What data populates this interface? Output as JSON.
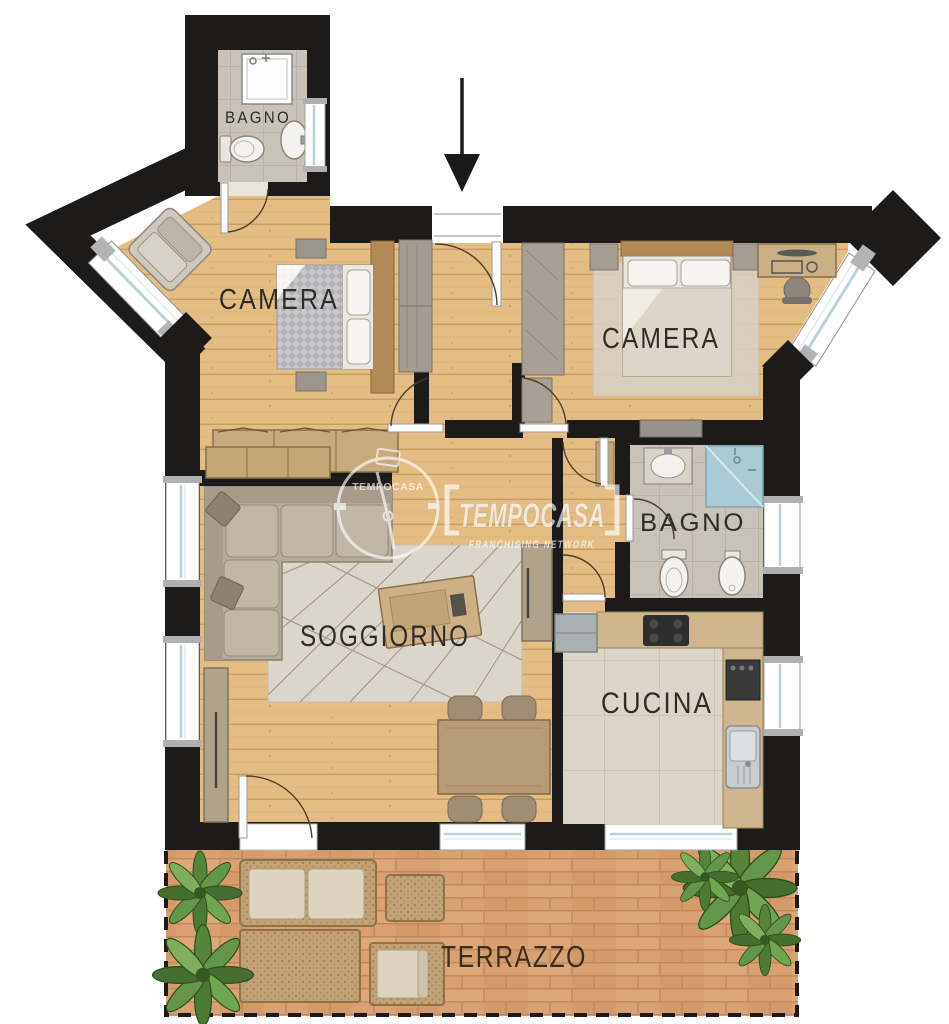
{
  "plan": {
    "type": "apartment-floorplan",
    "rooms": {
      "bagno_top": {
        "label": "BAGNO"
      },
      "camera_left": {
        "label": "CAMERA"
      },
      "camera_right": {
        "label": "CAMERA"
      },
      "bagno_right": {
        "label": "BAGNO"
      },
      "soggiorno": {
        "label": "SOGGIORNO"
      },
      "cucina": {
        "label": "CUCINA"
      },
      "terrazzo": {
        "label": "TERRAZZO"
      }
    }
  },
  "watermark": {
    "logo_text": "TEMPOCASA",
    "brand": "TEMPOCASA",
    "subtitle": "FRANCHISING NETWORK"
  },
  "colors": {
    "wall": "#1c1b1a",
    "wood_floor": "#e4bd84",
    "bath_tile": "#c9c2b9",
    "kitchen_tile": "#dbd4c7",
    "terrace_brick": "#d9a172",
    "window_glass": "#b7d3da",
    "shower_blue": "#a9cbd6",
    "watermark": "#ffffff"
  }
}
